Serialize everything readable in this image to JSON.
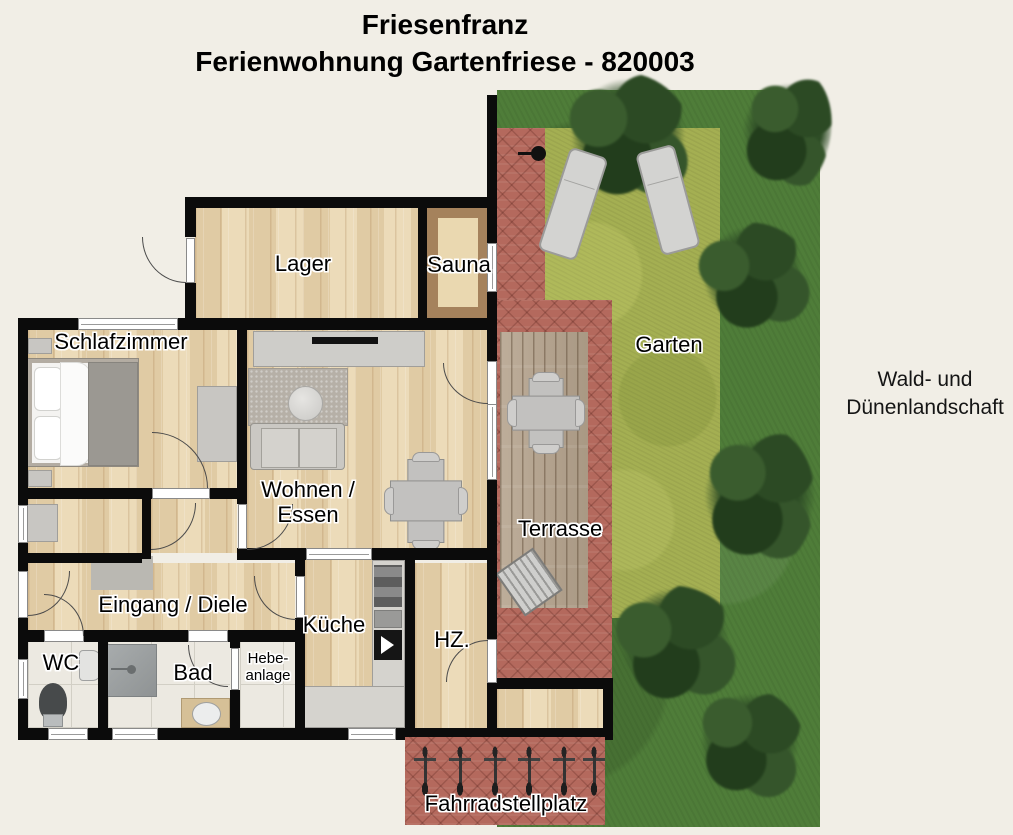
{
  "title": {
    "line1": "Friesenfranz",
    "line2": "Ferienwohnung Gartenfriese - 820003"
  },
  "floor_plan": {
    "rooms": {
      "lager": "Lager",
      "sauna": "Sauna",
      "schlafzimmer": "Schlafzimmer",
      "wohnen_essen": "Wohnen /\nEssen",
      "eingang_diele": "Eingang / Diele",
      "wc": "WC",
      "bad": "Bad",
      "hebeanlage": "Hebe-\nanlage",
      "kueche": "Küche",
      "hz": "HZ."
    }
  },
  "outdoor": {
    "garten": "Garten",
    "terrasse": "Terrasse",
    "fahrradstellplatz": "Fahrradstellplatz",
    "surroundings": "Wald- und\nDünenlandschaft",
    "bicycle_count": 6,
    "sun_lounger_count": 2
  },
  "colors": {
    "background": "#f1eee6",
    "wall": "#0b0b0b",
    "wood_floor": "#ead7b1",
    "tile_floor": "#ece9e1",
    "grass_dark": "#4f7d39",
    "grass_light": "#a4af52",
    "tree": "#2c4a24",
    "brick": "#b4695d",
    "deck": "#b4a28c",
    "sauna_wood": "#a5825c",
    "furniture_gray": "#c8c6c2",
    "door_arc": "#4b4b4b",
    "window_white": "#ffffff"
  },
  "icons": {
    "water-pump-icon": "css-shape",
    "bicycle-icon": "css-shape",
    "sun-lounger-icon": "css-shape",
    "tree-icon": "css-shape",
    "shower-icon": "css-shape",
    "toilet-icon": "css-shape",
    "washbasin-icon": "css-shape",
    "bed-icon": "css-shape",
    "sofa-icon": "css-shape",
    "coffee-table-icon": "css-shape",
    "dining-table-icon": "css-shape",
    "tv-sideboard-icon": "css-shape",
    "kitchen-counter-icon": "css-shape",
    "doormat-icon": "css-shape",
    "wardrobe-icon": "css-shape",
    "grill-box-icon": "css-shape"
  }
}
